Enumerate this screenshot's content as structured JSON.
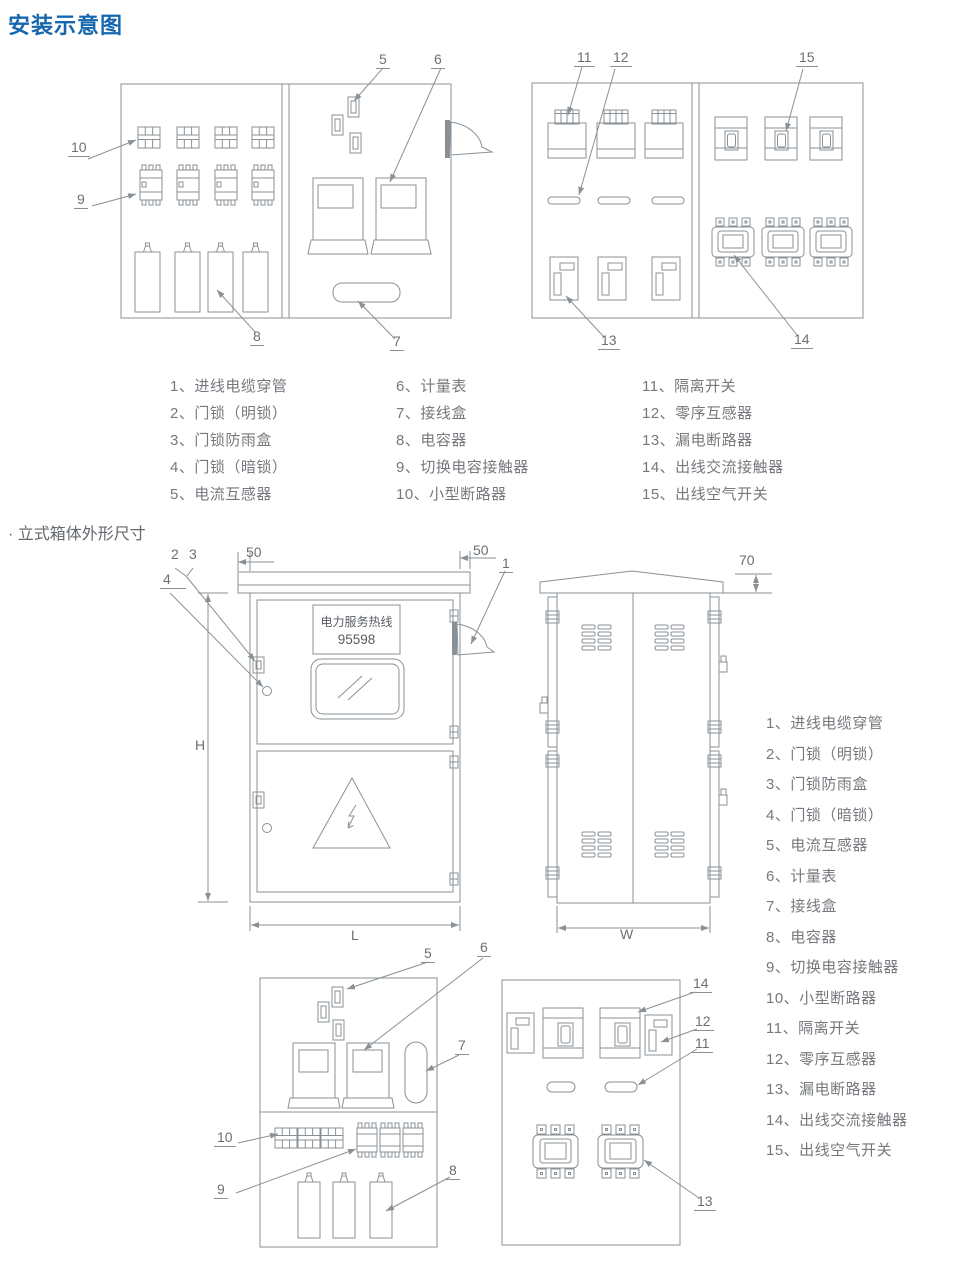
{
  "title": "安装示意图",
  "section_title": "· 立式箱体外形尺寸",
  "hotline": {
    "line1": "电力服务热线",
    "line2": "95598"
  },
  "legend_top": {
    "col1": [
      "1、进线电缆穿管",
      "2、门锁（明锁）",
      "3、门锁防雨盒",
      "4、门锁（暗锁）",
      "5、电流互感器"
    ],
    "col2": [
      "6、计量表",
      "7、接线盒",
      "8、电容器",
      "9、切换电容接触器",
      "10、小型断路器"
    ],
    "col3": [
      "11、隔离开关",
      "12、零序互感器",
      "13、漏电断路器",
      "14、出线交流接触器",
      "15、出线空气开关"
    ]
  },
  "legend_right": [
    "1、进线电缆穿管",
    "2、门锁（明锁）",
    "3、门锁防雨盒",
    "4、门锁（暗锁）",
    "5、电流互感器",
    "6、计量表",
    "7、接线盒",
    "8、电容器",
    "9、切换电容接触器",
    "10、小型断路器",
    "11、隔离开关",
    "12、零序互感器",
    "13、漏电断路器",
    "14、出线交流接触器",
    "15、出线空气开关"
  ],
  "callouts": {
    "top_left": {
      "n5": "5",
      "n6": "6",
      "n10": "10",
      "n9": "9",
      "n8": "8",
      "n7": "7"
    },
    "top_right": {
      "n11": "11",
      "n12": "12",
      "n15": "15",
      "n13": "13",
      "n14": "14"
    },
    "front": {
      "n1": "1",
      "n2": "2",
      "n3": "3",
      "n4": "4"
    },
    "bottom_left": {
      "n5": "5",
      "n6": "6",
      "n7": "7",
      "n10": "10",
      "n9": "9",
      "n8": "8"
    },
    "bottom_right": {
      "n14": "14",
      "n12": "12",
      "n11": "11",
      "n13": "13"
    }
  },
  "dims": {
    "H": "H",
    "L": "L",
    "W": "W",
    "left_overhang": "50",
    "right_overhang": "50",
    "roof_height": "70"
  },
  "colors": {
    "title_blue": "#1767ae",
    "line_gray": "#8a9196",
    "text_gray": "#75797d"
  }
}
